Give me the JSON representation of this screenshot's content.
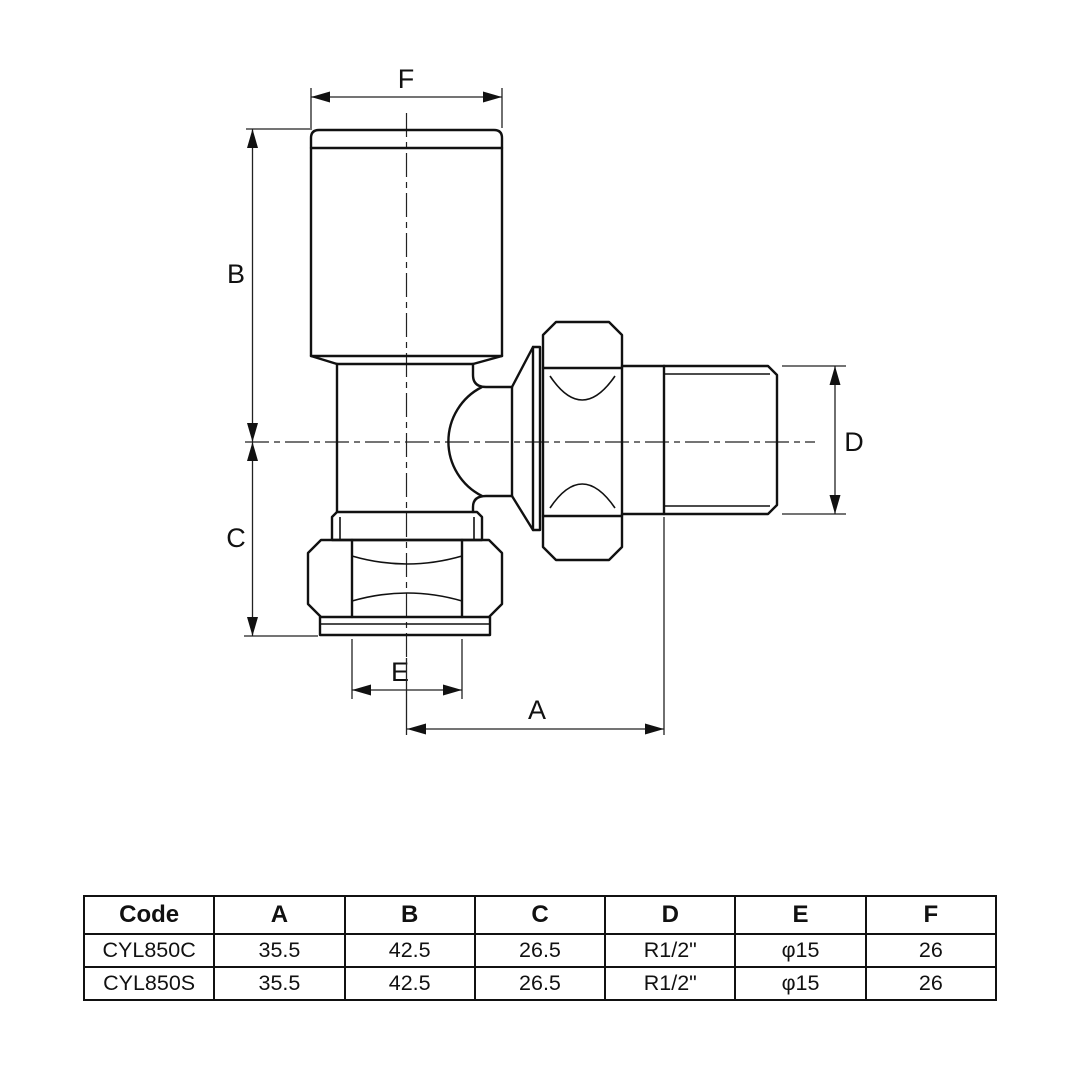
{
  "drawing": {
    "dim_labels": {
      "a": "A",
      "b": "B",
      "c": "C",
      "d": "D",
      "e": "E",
      "f": "F"
    }
  },
  "table": {
    "headers": [
      "Code",
      "A",
      "B",
      "C",
      "D",
      "E",
      "F"
    ],
    "rows": [
      [
        "CYL850C",
        "35.5",
        "42.5",
        "26.5",
        "R1/2\"",
        "φ15",
        "26"
      ],
      [
        "CYL850S",
        "35.5",
        "42.5",
        "26.5",
        "R1/2\"",
        "φ15",
        "26"
      ]
    ]
  },
  "colors": {
    "line": "#111111",
    "background": "#ffffff"
  }
}
